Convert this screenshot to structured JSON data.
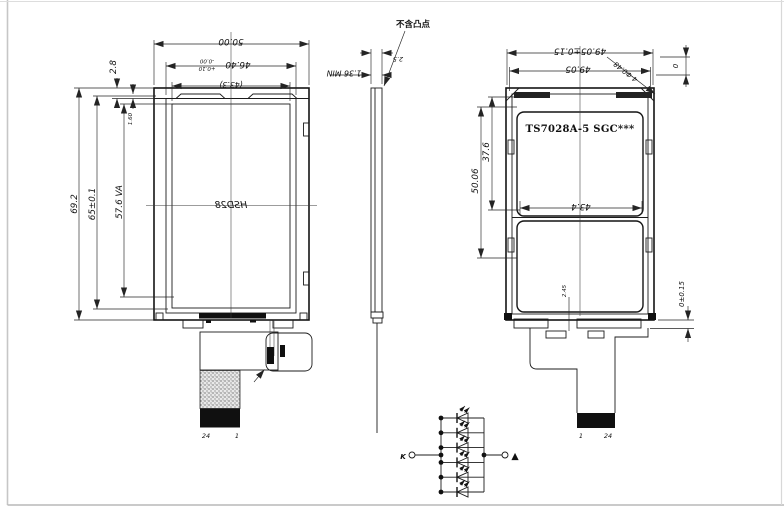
{
  "front": {
    "print": "HSD28",
    "pins": {
      "left": "24",
      "right": "1"
    },
    "dims": {
      "w_out": "50.00",
      "w_bezel": "46.40",
      "w_tol_upper": "-0.00",
      "w_tol_lower": "+0.10",
      "w_ref": "(43.3)",
      "h_out": "69.2",
      "h_bezel": "65±0.1",
      "h_va": "57.6 VA",
      "top": "2.8",
      "tab": "1.60"
    }
  },
  "side": {
    "note": "不含凸点",
    "dims": {
      "thk": "1.36 MIN",
      "gap": "2.5"
    }
  },
  "back": {
    "part": "TS7028A-5 SGC***",
    "pins": {
      "left": "1",
      "right": "24"
    },
    "dims": {
      "w_tol": "49.05±0.15",
      "w": "49.05",
      "hole": "4-Φ0.48",
      "zero": "0",
      "h1": "50.06",
      "h2": "37.6",
      "w_in": "43.4",
      "off": "2.45",
      "bot": "0±0.15"
    }
  },
  "led": {
    "k": "K",
    "a": "▲",
    "led_count": 6
  }
}
